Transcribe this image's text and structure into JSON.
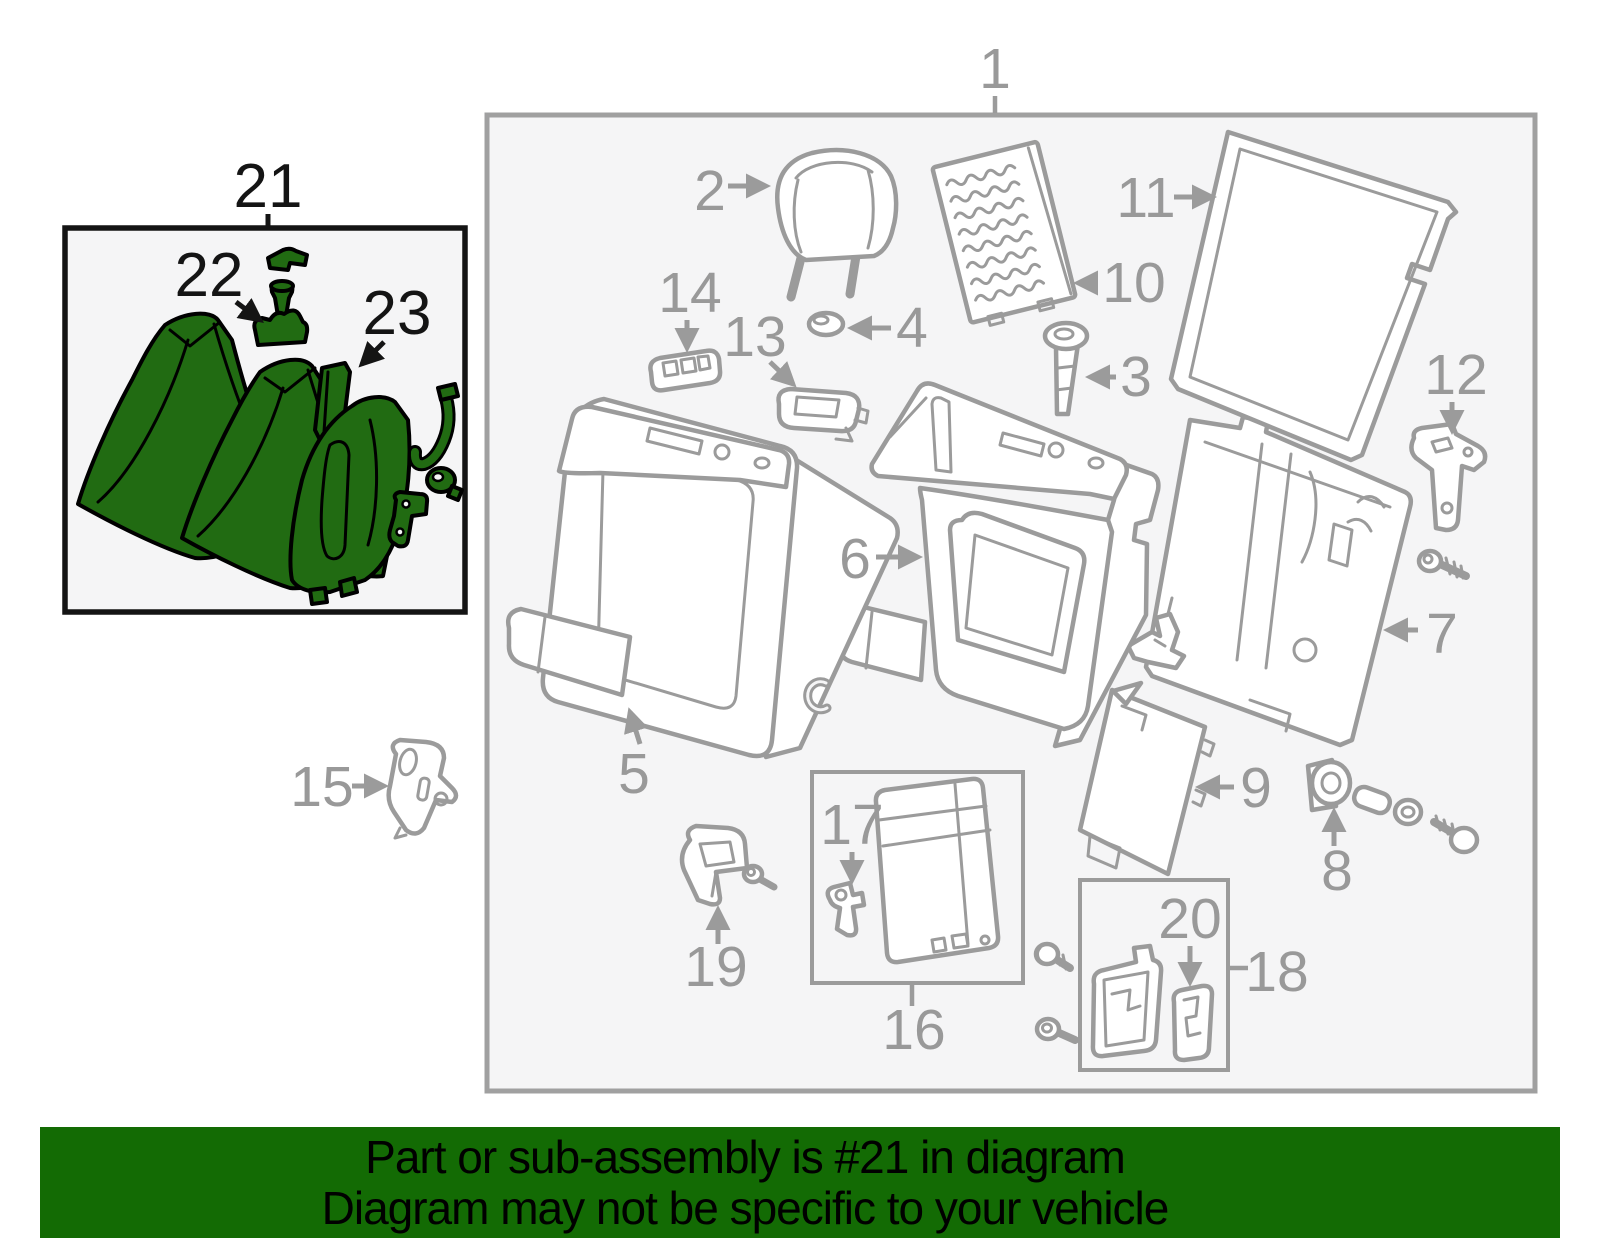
{
  "banner": {
    "line1": "Part or sub-assembly is #21 in diagram",
    "line2": "Diagram may not be specific to your vehicle",
    "background": "#136b04",
    "text_color": "#000000"
  },
  "diagram": {
    "box_background": "#f5f5f6",
    "line_color": "#9b9b9b",
    "label_color": "#999999",
    "main_box_border": "#a0a0a0",
    "highlight": {
      "box_border": "#141414",
      "part_fill": "#216b12",
      "part_outline": "#000000",
      "label_color": "#141414"
    },
    "labels": {
      "p1": {
        "text": "1"
      },
      "p2": {
        "text": "2"
      },
      "p3": {
        "text": "3"
      },
      "p4": {
        "text": "4"
      },
      "p5": {
        "text": "5"
      },
      "p6": {
        "text": "6"
      },
      "p7": {
        "text": "7"
      },
      "p8": {
        "text": "8"
      },
      "p9": {
        "text": "9"
      },
      "p10": {
        "text": "10"
      },
      "p11": {
        "text": "11"
      },
      "p12": {
        "text": "12"
      },
      "p13": {
        "text": "13"
      },
      "p14": {
        "text": "14"
      },
      "p15": {
        "text": "15"
      },
      "p16": {
        "text": "16"
      },
      "p17": {
        "text": "17"
      },
      "p18": {
        "text": "18"
      },
      "p19": {
        "text": "19"
      },
      "p20": {
        "text": "20"
      },
      "p21": {
        "text": "21"
      },
      "p22": {
        "text": "22"
      },
      "p23": {
        "text": "23"
      }
    }
  }
}
